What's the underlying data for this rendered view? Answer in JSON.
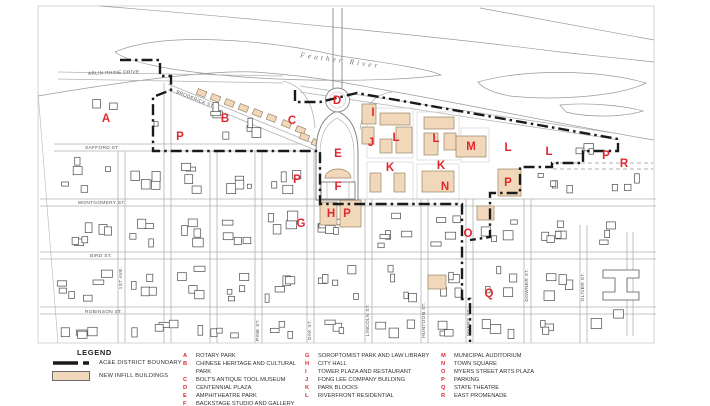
{
  "colors": {
    "marker_red": "#e0272e",
    "infill_fill": "#f2d8ba",
    "infill_stroke": "#9a8468",
    "boundary": "#1a1a1a",
    "street_line": "#b3b3b3",
    "building_line": "#4a4a4a",
    "river_line": "#9a9a9a"
  },
  "map": {
    "river_label": "Feather River",
    "streets": {
      "horizontal": [
        {
          "name": "ARLIN RHINE DRIVE",
          "x": 88,
          "y": 75,
          "rotation": -2
        },
        {
          "name": "BRODERICK ST.",
          "x": 176,
          "y": 93,
          "rotation": 22
        },
        {
          "name": "SAFFORD ST.",
          "x": 85,
          "y": 149,
          "rotation": 0
        },
        {
          "name": "MONTGOMERY ST.",
          "x": 78,
          "y": 204,
          "rotation": 0
        },
        {
          "name": "BIRD ST.",
          "x": 90,
          "y": 257,
          "rotation": 0
        },
        {
          "name": "ROBINSON ST.",
          "x": 85,
          "y": 313,
          "rotation": 0
        }
      ],
      "vertical": [
        {
          "name": "1ST AVE.",
          "x": 122,
          "y": 278
        },
        {
          "name": "PINE ST.",
          "x": 259,
          "y": 330
        },
        {
          "name": "OAK ST.",
          "x": 311,
          "y": 330
        },
        {
          "name": "LINCOLN ST.",
          "x": 369,
          "y": 320
        },
        {
          "name": "HUNTOON ST.",
          "x": 425,
          "y": 320
        },
        {
          "name": "MYERS ST.",
          "x": 470,
          "y": 322
        },
        {
          "name": "DOWNER ST.",
          "x": 528,
          "y": 285
        },
        {
          "name": "OLIVER ST.",
          "x": 584,
          "y": 287
        }
      ]
    },
    "markers": [
      {
        "letter": "A",
        "x": 106,
        "y": 118
      },
      {
        "letter": "P",
        "x": 180,
        "y": 136
      },
      {
        "letter": "B",
        "x": 225,
        "y": 118
      },
      {
        "letter": "C",
        "x": 292,
        "y": 120
      },
      {
        "letter": "D",
        "x": 337,
        "y": 100
      },
      {
        "letter": "I",
        "x": 373,
        "y": 112
      },
      {
        "letter": "J",
        "x": 371,
        "y": 142
      },
      {
        "letter": "L",
        "x": 396,
        "y": 137
      },
      {
        "letter": "L",
        "x": 436,
        "y": 138
      },
      {
        "letter": "M",
        "x": 471,
        "y": 146
      },
      {
        "letter": "L",
        "x": 508,
        "y": 147
      },
      {
        "letter": "L",
        "x": 549,
        "y": 151
      },
      {
        "letter": "P",
        "x": 606,
        "y": 155
      },
      {
        "letter": "R",
        "x": 624,
        "y": 163
      },
      {
        "letter": "E",
        "x": 338,
        "y": 153
      },
      {
        "letter": "K",
        "x": 390,
        "y": 167
      },
      {
        "letter": "K",
        "x": 441,
        "y": 165
      },
      {
        "letter": "N",
        "x": 445,
        "y": 186
      },
      {
        "letter": "F",
        "x": 338,
        "y": 186
      },
      {
        "letter": "P",
        "x": 297,
        "y": 179
      },
      {
        "letter": "G",
        "x": 301,
        "y": 223
      },
      {
        "letter": "H",
        "x": 331,
        "y": 213
      },
      {
        "letter": "P",
        "x": 347,
        "y": 213
      },
      {
        "letter": "P",
        "x": 508,
        "y": 182
      },
      {
        "letter": "O",
        "x": 468,
        "y": 233
      },
      {
        "letter": "Q",
        "x": 489,
        "y": 293
      }
    ]
  },
  "legend": {
    "title": "LEGEND",
    "line_items": [
      {
        "label": "AC&E DISTRICT BOUNDARY"
      },
      {
        "label": "NEW INFILL BUILDINGS"
      }
    ],
    "columns": [
      {
        "entries": [
          {
            "key": "A",
            "label": "ROTARY PARK"
          },
          {
            "key": "B",
            "label": "CHINESE HERITAGE AND CULTURAL PARK"
          },
          {
            "key": "C",
            "label": "BOLT'S ANTIQUE TOOL MUSEUM"
          },
          {
            "key": "D",
            "label": "CENTENNIAL PLAZA"
          },
          {
            "key": "E",
            "label": "AMPHITHEATRE PARK"
          },
          {
            "key": "F",
            "label": "BACKSTAGE STUDIO AND GALLERY"
          }
        ]
      },
      {
        "entries": [
          {
            "key": "G",
            "label": "SOROPTOMIST PARK AND LAW LIBRARY"
          },
          {
            "key": "H",
            "label": "CITY HALL"
          },
          {
            "key": "I",
            "label": "TOWER PLAZA AND RESTAURANT"
          },
          {
            "key": "J",
            "label": "FONG LEE COMPANY BUILDING"
          },
          {
            "key": "K",
            "label": "PARK BLOCKS"
          },
          {
            "key": "L",
            "label": "RIVERFRONT RESIDENTIAL"
          }
        ]
      },
      {
        "entries": [
          {
            "key": "M",
            "label": "MUNICIPAL AUDITORIUM"
          },
          {
            "key": "N",
            "label": "TOWN SQUARE"
          },
          {
            "key": "O",
            "label": "MYERS STREET ARTS PLAZA"
          },
          {
            "key": "P",
            "label": "PARKING"
          },
          {
            "key": "Q",
            "label": "STATE THEATRE"
          },
          {
            "key": "R",
            "label": "EAST PROMENADE"
          }
        ]
      }
    ]
  }
}
